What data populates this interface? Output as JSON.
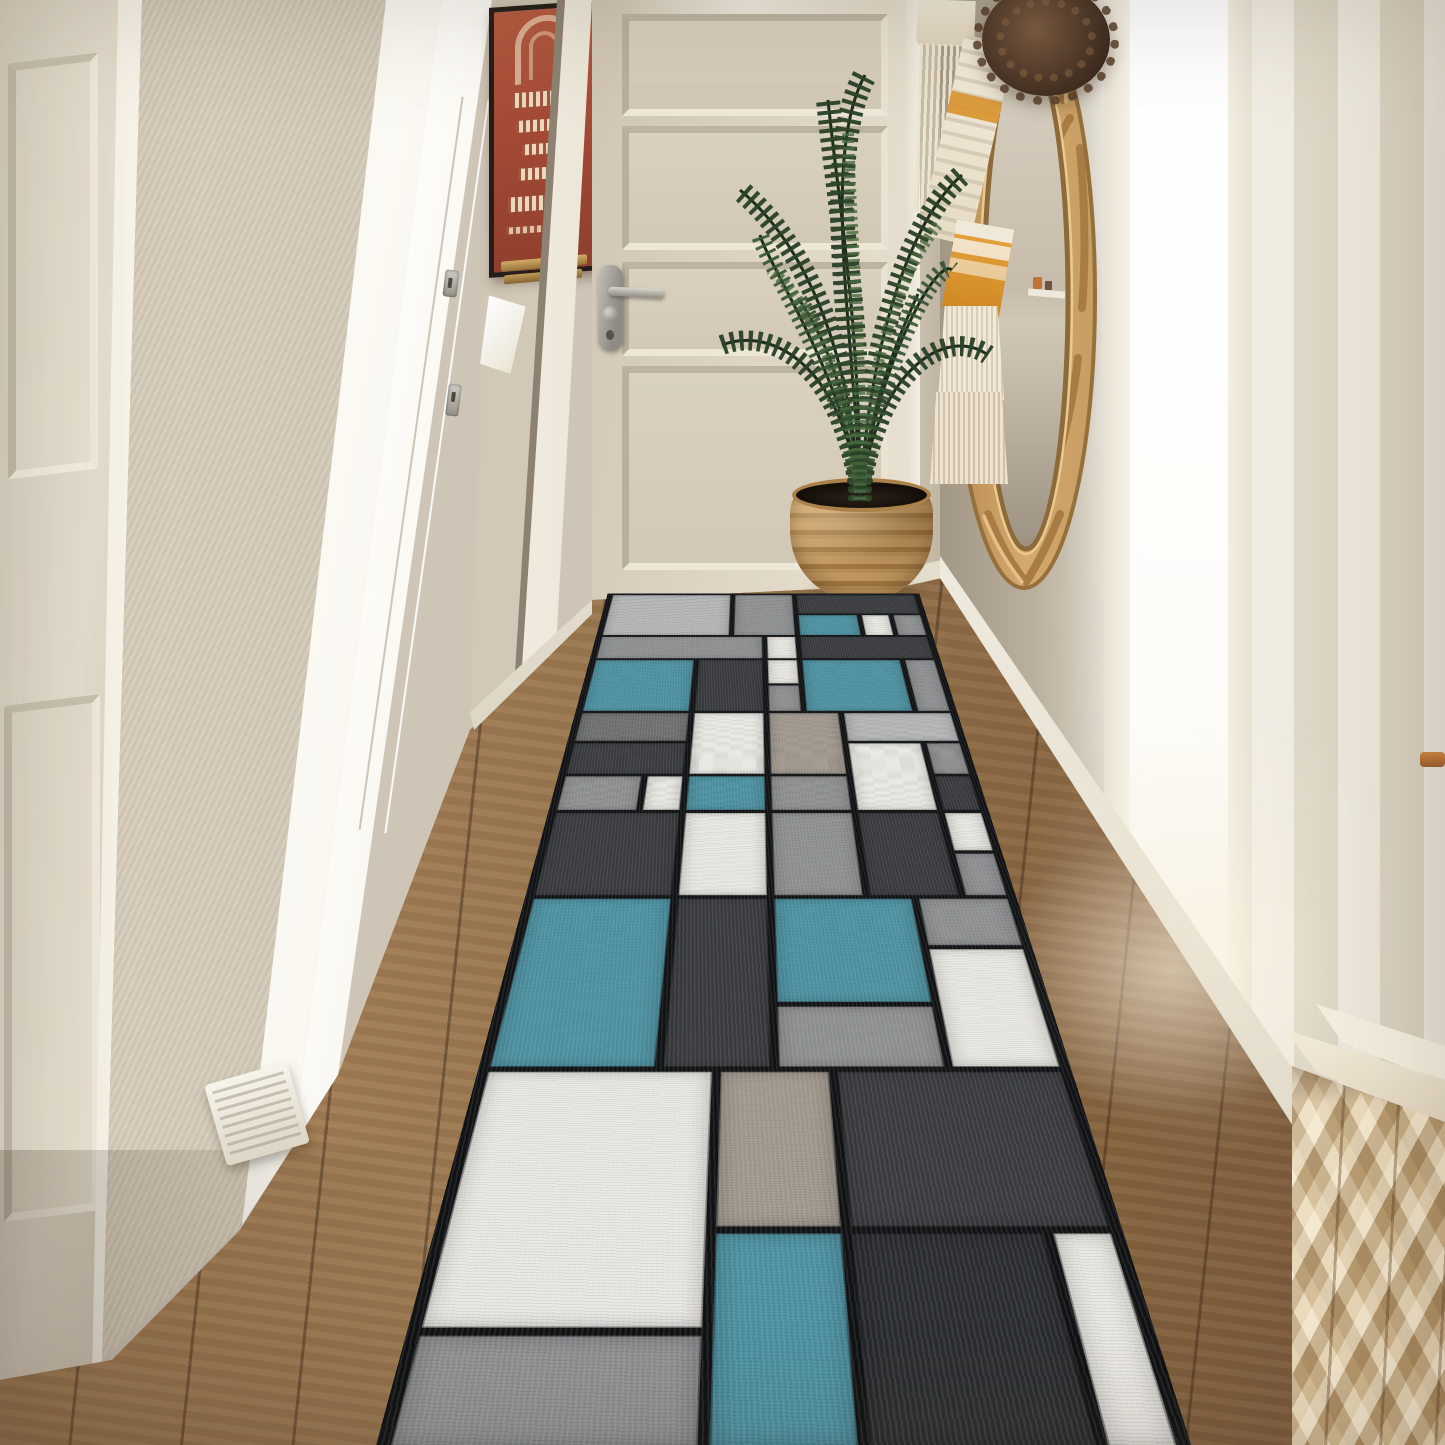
{
  "image": {
    "type": "natural-photo",
    "subject": "Bright hallway entry with a modern geometric color-block runner rug",
    "width_px": 1445,
    "height_px": 1445
  },
  "objects": {
    "far_left_door": {
      "label": "cream paneled door on far left",
      "color": "#ddd3c2"
    },
    "wall_pilaster": {
      "label": "textured beige wall panel",
      "color": "#cfc5b3"
    },
    "pocket_door": {
      "label": "brightly lit white pocket door with steel latches",
      "color": "#fbf9f3"
    },
    "poster": {
      "label": "framed red vintage poster on left wall",
      "paper_color": "#a84a36",
      "frame_color": "#241d18",
      "ledge_color": "#b9964f"
    },
    "wall_tag": {
      "label": "small white tag hanging below poster",
      "color": "#f5efe2"
    },
    "hallway_door": {
      "label": "cream four-panel door at end of hallway",
      "color": "#ded5c5",
      "handle": "silver lever on left stile",
      "handle_color": "#a09d95"
    },
    "palm_plant": {
      "label": "potted areca palm in corner",
      "foliage_color": "#2c4527"
    },
    "planter": {
      "label": "woven seagrass basket planter",
      "color": "#b8905a"
    },
    "mirror": {
      "label": "round carved rattan mirror hung on right wall, seen at an angle",
      "frame_color": "#c49a62",
      "glass_reflection": "beige wall with small shelf and orange objects"
    },
    "macrame": {
      "label": "macrame hanging with tassels draped over mirror",
      "colors": [
        "#f0e8d8",
        "#d8932e"
      ]
    },
    "pompom": {
      "label": "dried brown pampas pom-pom at mirror top",
      "color": "#4a3526"
    },
    "fringe_hanging": {
      "label": "white fringed wall hanging left of mirror",
      "color": "#ece3d0"
    },
    "doorway_light": {
      "label": "bright daylight strip through doorway on right",
      "color": "#ffffff"
    },
    "textured_wall": {
      "label": "striped textured cream wall on far right",
      "color": "#e8e2d4"
    },
    "wood_floor": {
      "label": "oak hardwood plank floor",
      "color": "#96744c"
    },
    "runner_rug": {
      "label": "modern boxes runner rug in blue, gray, white and charcoal"
    },
    "cabinet": {
      "label": "light wood cabinet with 3D faceted front, bottom right",
      "color": "#d9c29b"
    },
    "baseboards": {
      "label": "white baseboards",
      "color": "#efe9dc"
    },
    "doorstop": {
      "label": "small white wooden ramp at pocket door base",
      "color": "#f0ece0"
    }
  },
  "palette": {
    "wall_beige": "#cfc5b6",
    "wall_taupe": "#bfb4a2",
    "door_cream": "#ddd3c2",
    "bright_white": "#fbf9f3",
    "floor_wood": "#96744c",
    "rattan": "#c49a62",
    "plant_green": "#2c4527",
    "cabinet_wood": "#d9c29b",
    "poster_red": "#a84a36",
    "macrame_orange": "#d8932e"
  },
  "rug": {
    "columns": 10,
    "rows": 17,
    "gap_color": "#101213",
    "colors": {
      "T": "#4e92a3",
      "LG": "#b4b7b8",
      "G": "#8f9293",
      "MG": "#6f7273",
      "DG": "#3a3d3f",
      "D2": "#2b2e30",
      "W": "#eae8e3",
      "TAN": "#a29a8e"
    },
    "blocks": [
      {
        "c": 1,
        "cs": 4,
        "r": 1,
        "rs": 2,
        "k": "LG"
      },
      {
        "c": 5,
        "cs": 2,
        "r": 1,
        "rs": 2,
        "k": "G"
      },
      {
        "c": 7,
        "cs": 4,
        "r": 1,
        "rs": 1,
        "k": "DG"
      },
      {
        "c": 7,
        "cs": 2,
        "r": 2,
        "rs": 1,
        "k": "T"
      },
      {
        "c": 9,
        "cs": 1,
        "r": 2,
        "rs": 1,
        "k": "W"
      },
      {
        "c": 10,
        "cs": 1,
        "r": 2,
        "rs": 1,
        "k": "G"
      },
      {
        "c": 1,
        "cs": 5,
        "r": 3,
        "rs": 1,
        "k": "G"
      },
      {
        "c": 6,
        "cs": 1,
        "r": 3,
        "rs": 1,
        "k": "W"
      },
      {
        "c": 7,
        "cs": 4,
        "r": 3,
        "rs": 1,
        "k": "DG"
      },
      {
        "c": 1,
        "cs": 3,
        "r": 4,
        "rs": 2,
        "k": "T"
      },
      {
        "c": 4,
        "cs": 2,
        "r": 4,
        "rs": 2,
        "k": "DG"
      },
      {
        "c": 6,
        "cs": 1,
        "r": 4,
        "rs": 1,
        "k": "W"
      },
      {
        "c": 7,
        "cs": 3,
        "r": 4,
        "rs": 2,
        "k": "T"
      },
      {
        "c": 10,
        "cs": 1,
        "r": 4,
        "rs": 2,
        "k": "G"
      },
      {
        "c": 6,
        "cs": 1,
        "r": 5,
        "rs": 1,
        "k": "G"
      },
      {
        "c": 1,
        "cs": 3,
        "r": 6,
        "rs": 1,
        "k": "MG"
      },
      {
        "c": 4,
        "cs": 2,
        "r": 6,
        "rs": 2,
        "k": "W"
      },
      {
        "c": 6,
        "cs": 2,
        "r": 6,
        "rs": 2,
        "k": "TAN"
      },
      {
        "c": 8,
        "cs": 3,
        "r": 6,
        "rs": 1,
        "k": "LG"
      },
      {
        "c": 1,
        "cs": 3,
        "r": 7,
        "rs": 1,
        "k": "DG"
      },
      {
        "c": 8,
        "cs": 2,
        "r": 7,
        "rs": 2,
        "k": "W"
      },
      {
        "c": 10,
        "cs": 1,
        "r": 7,
        "rs": 1,
        "k": "G"
      },
      {
        "c": 1,
        "cs": 2,
        "r": 8,
        "rs": 1,
        "k": "G"
      },
      {
        "c": 3,
        "cs": 1,
        "r": 8,
        "rs": 1,
        "k": "W"
      },
      {
        "c": 4,
        "cs": 2,
        "r": 8,
        "rs": 1,
        "k": "T"
      },
      {
        "c": 6,
        "cs": 2,
        "r": 8,
        "rs": 1,
        "k": "G"
      },
      {
        "c": 10,
        "cs": 1,
        "r": 8,
        "rs": 1,
        "k": "DG"
      },
      {
        "c": 1,
        "cs": 3,
        "r": 9,
        "rs": 2,
        "k": "DG"
      },
      {
        "c": 4,
        "cs": 2,
        "r": 9,
        "rs": 2,
        "k": "W"
      },
      {
        "c": 6,
        "cs": 2,
        "r": 9,
        "rs": 2,
        "k": "G"
      },
      {
        "c": 8,
        "cs": 2,
        "r": 9,
        "rs": 2,
        "k": "DG"
      },
      {
        "c": 10,
        "cs": 1,
        "r": 9,
        "rs": 1,
        "k": "W"
      },
      {
        "c": 10,
        "cs": 1,
        "r": 10,
        "rs": 1,
        "k": "G"
      },
      {
        "c": 1,
        "cs": 3,
        "r": 11,
        "rs": 3,
        "k": "T"
      },
      {
        "c": 4,
        "cs": 2,
        "r": 11,
        "rs": 3,
        "k": "DG"
      },
      {
        "c": 6,
        "cs": 3,
        "r": 11,
        "rs": 2,
        "k": "T"
      },
      {
        "c": 9,
        "cs": 2,
        "r": 11,
        "rs": 1,
        "k": "G"
      },
      {
        "c": 9,
        "cs": 2,
        "r": 12,
        "rs": 2,
        "k": "W"
      },
      {
        "c": 6,
        "cs": 3,
        "r": 13,
        "rs": 1,
        "k": "G"
      },
      {
        "c": 1,
        "cs": 4,
        "r": 14,
        "rs": 3,
        "k": "W"
      },
      {
        "c": 5,
        "cs": 2,
        "r": 14,
        "rs": 2,
        "k": "TAN"
      },
      {
        "c": 7,
        "cs": 4,
        "r": 14,
        "rs": 2,
        "k": "DG"
      },
      {
        "c": 5,
        "cs": 2,
        "r": 16,
        "rs": 2,
        "k": "T"
      },
      {
        "c": 7,
        "cs": 3,
        "r": 16,
        "rs": 2,
        "k": "D2"
      },
      {
        "c": 10,
        "cs": 1,
        "r": 16,
        "rs": 2,
        "k": "W"
      },
      {
        "c": 1,
        "cs": 4,
        "r": 17,
        "rs": 1,
        "k": "G"
      }
    ]
  }
}
